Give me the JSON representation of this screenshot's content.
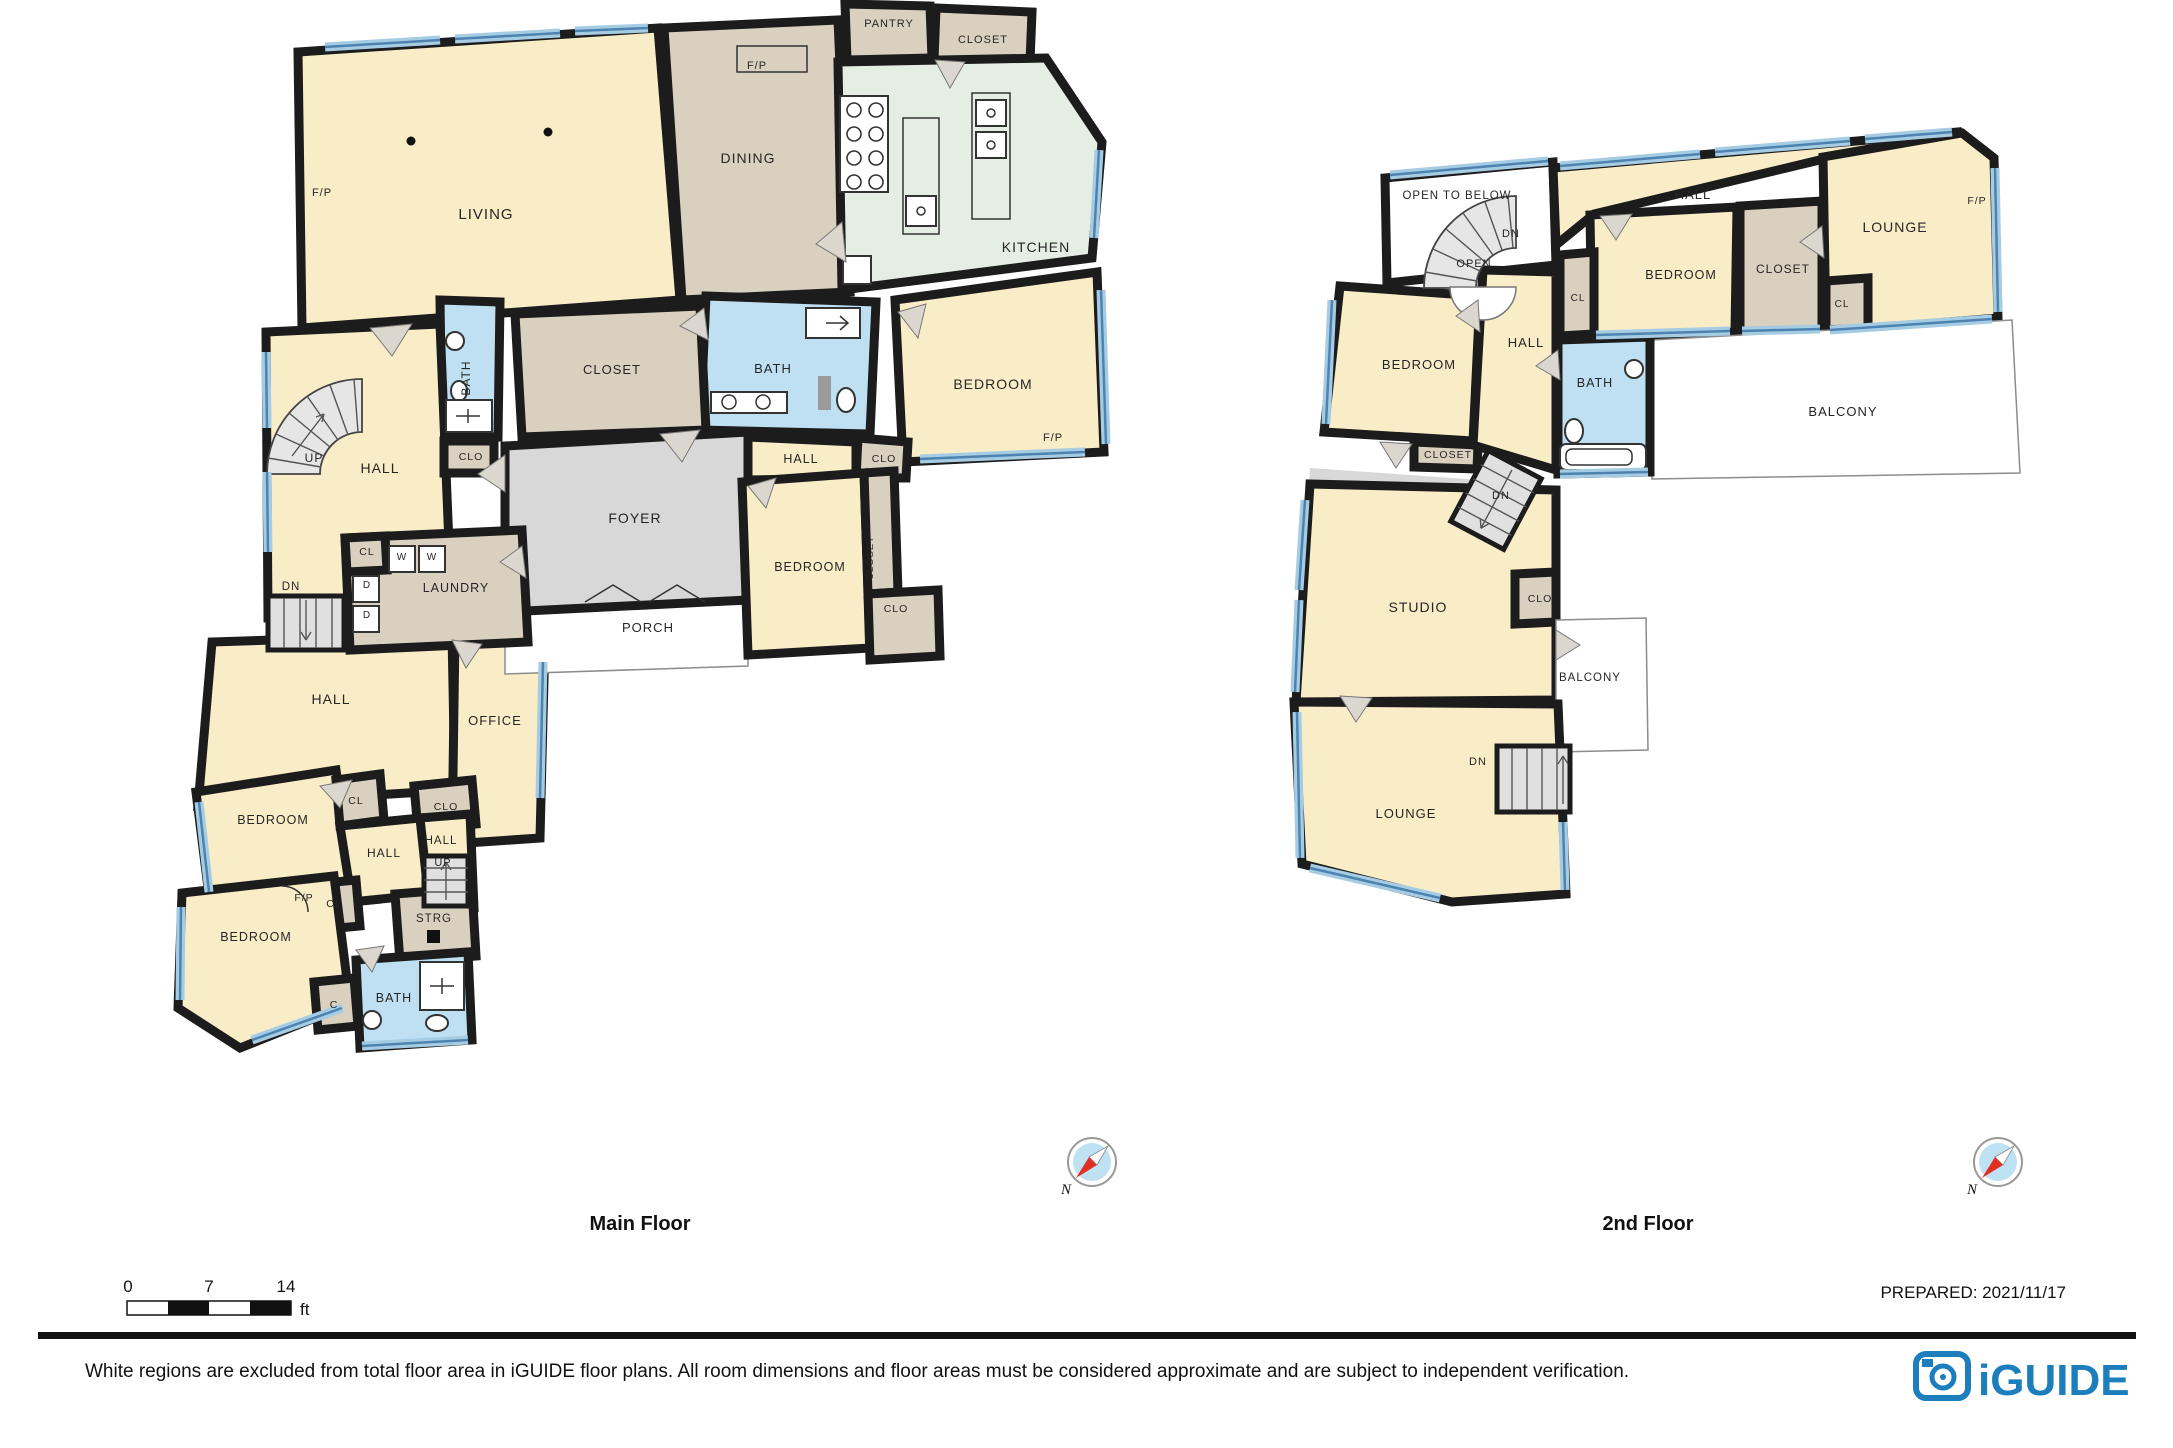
{
  "floors": [
    {
      "name": "Main Floor",
      "labels": [
        {
          "t": "LIVING",
          "x": 486,
          "y": 219,
          "s": 15
        },
        {
          "t": "F/P",
          "x": 322,
          "y": 196,
          "s": 11
        },
        {
          "t": "DINING",
          "x": 748,
          "y": 163,
          "s": 14
        },
        {
          "t": "F/P",
          "x": 757,
          "y": 69,
          "s": 11
        },
        {
          "t": "PANTRY",
          "x": 889,
          "y": 27,
          "s": 11
        },
        {
          "t": "CLOSET",
          "x": 983,
          "y": 43,
          "s": 11
        },
        {
          "t": "KITCHEN",
          "x": 1036,
          "y": 252,
          "s": 14
        },
        {
          "t": "BEDROOM",
          "x": 993,
          "y": 389,
          "s": 14
        },
        {
          "t": "F/P",
          "x": 1053,
          "y": 441,
          "s": 11
        },
        {
          "t": "BATH",
          "x": 773,
          "y": 373,
          "s": 13
        },
        {
          "t": "CLOSET",
          "x": 612,
          "y": 374,
          "s": 13
        },
        {
          "t": "BATH",
          "x": 470,
          "y": 378,
          "s": 12,
          "r": -90
        },
        {
          "t": "UP",
          "x": 314,
          "y": 462,
          "s": 12
        },
        {
          "t": "HALL",
          "x": 380,
          "y": 473,
          "s": 14
        },
        {
          "t": "CLO",
          "x": 471,
          "y": 460,
          "s": 10.5
        },
        {
          "t": "HALL",
          "x": 801,
          "y": 463,
          "s": 12.5
        },
        {
          "t": "CLO",
          "x": 884,
          "y": 462,
          "s": 10.5
        },
        {
          "t": "FOYER",
          "x": 635,
          "y": 523,
          "s": 14
        },
        {
          "t": "BEDROOM",
          "x": 810,
          "y": 571,
          "s": 12.5
        },
        {
          "t": "CLOSET",
          "x": 873,
          "y": 558,
          "s": 9.5,
          "r": -90
        },
        {
          "t": "CLO",
          "x": 896,
          "y": 612,
          "s": 10.5
        },
        {
          "t": "CL",
          "x": 367,
          "y": 555,
          "s": 10.5
        },
        {
          "t": "W",
          "x": 402,
          "y": 560,
          "s": 10
        },
        {
          "t": "W",
          "x": 432,
          "y": 560,
          "s": 10
        },
        {
          "t": "D",
          "x": 367,
          "y": 588,
          "s": 10
        },
        {
          "t": "D",
          "x": 367,
          "y": 618,
          "s": 10
        },
        {
          "t": "LAUNDRY",
          "x": 456,
          "y": 592,
          "s": 12.5
        },
        {
          "t": "DN",
          "x": 291,
          "y": 590,
          "s": 11.5
        },
        {
          "t": "PORCH",
          "x": 648,
          "y": 632,
          "s": 13
        },
        {
          "t": "HALL",
          "x": 331,
          "y": 704,
          "s": 14
        },
        {
          "t": "OFFICE",
          "x": 495,
          "y": 725,
          "s": 13
        },
        {
          "t": "BEDROOM",
          "x": 273,
          "y": 824,
          "s": 12.5
        },
        {
          "t": "CL",
          "x": 356,
          "y": 804,
          "s": 10.5
        },
        {
          "t": "CLO",
          "x": 446,
          "y": 810,
          "s": 10.5
        },
        {
          "t": "HALL",
          "x": 384,
          "y": 857,
          "s": 12
        },
        {
          "t": "HALL",
          "x": 441,
          "y": 844,
          "s": 11.5
        },
        {
          "t": "UP",
          "x": 443,
          "y": 866,
          "s": 11
        },
        {
          "t": "F/P",
          "x": 304,
          "y": 901,
          "s": 10.5
        },
        {
          "t": "CL",
          "x": 334,
          "y": 907,
          "s": 10.5
        },
        {
          "t": "STRG",
          "x": 434,
          "y": 922,
          "s": 11.5
        },
        {
          "t": "BEDROOM",
          "x": 256,
          "y": 941,
          "s": 12.5
        },
        {
          "t": "C",
          "x": 334,
          "y": 1008,
          "s": 10.5
        },
        {
          "t": "BATH",
          "x": 394,
          "y": 1002,
          "s": 12.5
        }
      ]
    },
    {
      "name": "2nd Floor",
      "labels": [
        {
          "t": "OPEN TO BELOW",
          "x": 1457,
          "y": 199,
          "s": 11.5
        },
        {
          "t": "DN",
          "x": 1511,
          "y": 237,
          "s": 11
        },
        {
          "t": "OPEN",
          "x": 1474,
          "y": 267,
          "s": 11
        },
        {
          "t": "HALL",
          "x": 1693,
          "y": 199,
          "s": 13
        },
        {
          "t": "LOUNGE",
          "x": 1895,
          "y": 232,
          "s": 14
        },
        {
          "t": "F/P",
          "x": 1977,
          "y": 204,
          "s": 10.5
        },
        {
          "t": "BEDROOM",
          "x": 1681,
          "y": 279,
          "s": 12.5
        },
        {
          "t": "CLOSET",
          "x": 1783,
          "y": 273,
          "s": 12
        },
        {
          "t": "CL",
          "x": 1578,
          "y": 301,
          "s": 10
        },
        {
          "t": "CL",
          "x": 1842,
          "y": 307,
          "s": 10
        },
        {
          "t": "BEDROOM",
          "x": 1419,
          "y": 369,
          "s": 13
        },
        {
          "t": "HALL",
          "x": 1526,
          "y": 347,
          "s": 13
        },
        {
          "t": "BATH",
          "x": 1595,
          "y": 387,
          "s": 12.5
        },
        {
          "t": "BALCONY",
          "x": 1843,
          "y": 416,
          "s": 13
        },
        {
          "t": "CLOSET",
          "x": 1448,
          "y": 458,
          "s": 10.5
        },
        {
          "t": "DN",
          "x": 1501,
          "y": 499,
          "s": 11
        },
        {
          "t": "STUDIO",
          "x": 1418,
          "y": 612,
          "s": 14
        },
        {
          "t": "CLO",
          "x": 1540,
          "y": 602,
          "s": 10.5
        },
        {
          "t": "BALCONY",
          "x": 1590,
          "y": 681,
          "s": 11.5
        },
        {
          "t": "DN",
          "x": 1478,
          "y": 765,
          "s": 11
        },
        {
          "t": "LOUNGE",
          "x": 1406,
          "y": 818,
          "s": 13
        }
      ]
    }
  ],
  "scale_bar": {
    "ticks": [
      "0",
      "7",
      "14"
    ],
    "unit": "ft"
  },
  "compass": {
    "label": "N"
  },
  "footer": {
    "prepared": "PREPARED: 2021/11/17",
    "disclaimer": "White regions are excluded from total floor area in iGUIDE floor plans. All room dimensions and floor areas must be considered approximate and are subject to independent verification.",
    "logo_text": "iGUIDE"
  },
  "colors": {
    "wall": "#1c1c1c",
    "room_cream": "#F9EDC8",
    "closet_tan": "#D9D0C0",
    "bath_blue": "#BFE0F2",
    "kitchen_green": "#E5EEE3",
    "foyer_gray": "#D8D8D8",
    "window_band": "#A6CCE3",
    "window_line": "#4D83B0",
    "logo_blue": "#1C7EBD",
    "compass_fill": "#BEE2F4",
    "needle_red": "#E03024"
  }
}
